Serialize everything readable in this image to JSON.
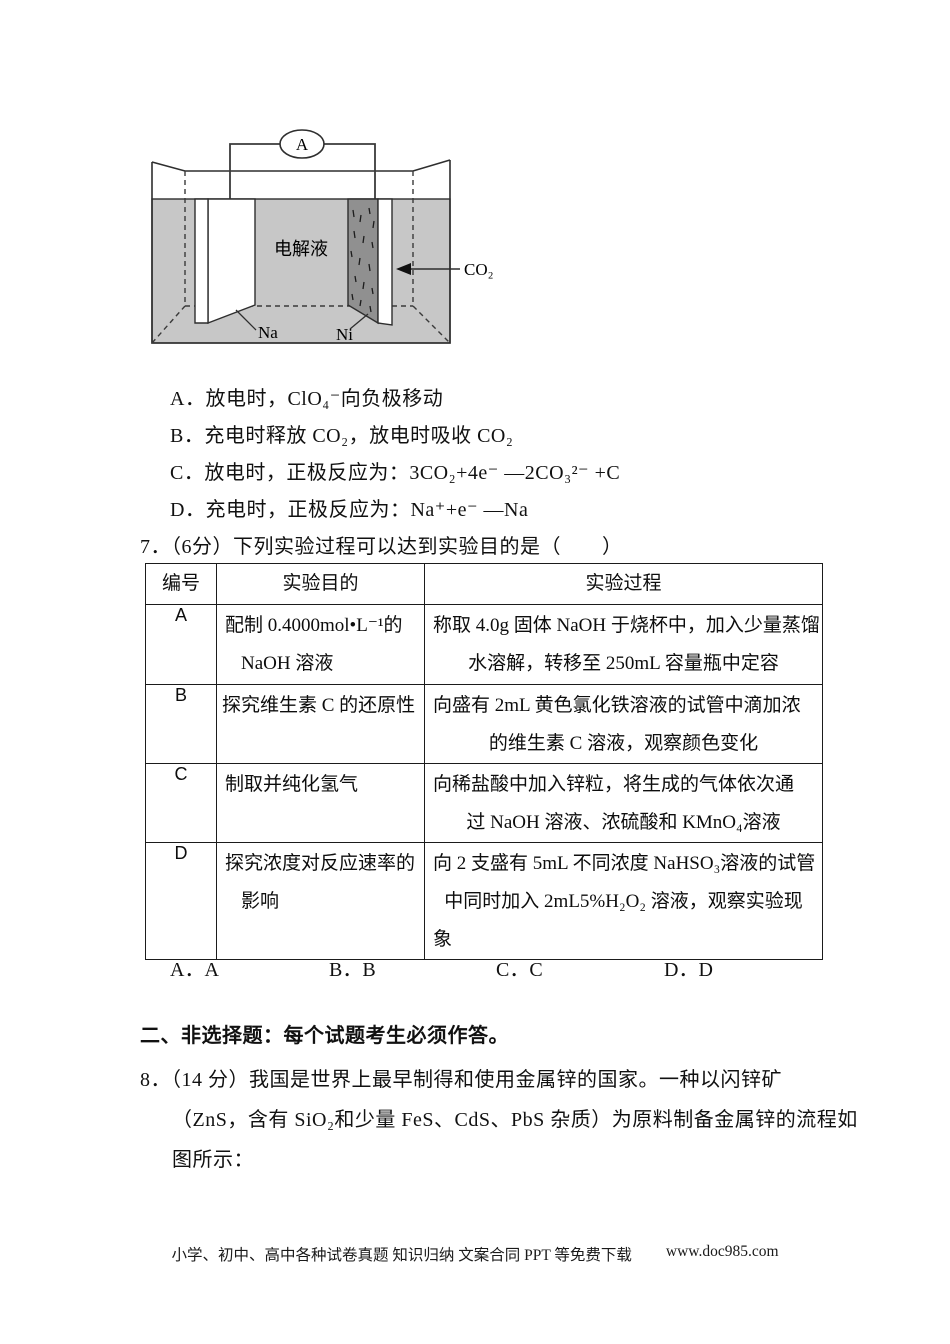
{
  "diagram": {
    "ammeter_label": "A",
    "electrolyte_label": "电解液",
    "co2_label": "CO₂",
    "left_electrode_label": "Na",
    "right_electrode_label": "Ni",
    "colors": {
      "electrolyte": "#c7c7c7",
      "cathode_fill": "#909090",
      "line": "#2e2e2e"
    }
  },
  "question6_options": [
    "A．放电时，ClO₄⁻向负极移动",
    "B．充电时释放 CO₂，放电时吸收 CO₂",
    "C．放电时，正极反应为：3CO₂+4e⁻ —2CO₃²⁻ +C",
    "D．充电时，正极反应为：Na⁺+e⁻ —Na"
  ],
  "question7": {
    "stem": "7．（6分）下列实验过程可以达到实验目的是（　　）",
    "table": {
      "headers": [
        "编号",
        "实验目的",
        "实验过程"
      ],
      "rows": [
        {
          "id": "A",
          "purpose": [
            "配制 0.4000mol•L⁻¹的",
            "NaOH 溶液"
          ],
          "process": [
            "称取 4.0g 固体 NaOH 于烧杯中，加入少量蒸馏",
            "水溶解，转移至 250mL 容量瓶中定容"
          ]
        },
        {
          "id": "B",
          "purpose": [
            "探究维生素 C 的还原性"
          ],
          "process": [
            "向盛有 2mL 黄色氯化铁溶液的试管中滴加浓",
            "的维生素 C 溶液，观察颜色变化"
          ]
        },
        {
          "id": "C",
          "purpose": [
            "制取并纯化氢气"
          ],
          "process": [
            "向稀盐酸中加入锌粒，将生成的气体依次通",
            "过 NaOH 溶液、浓硫酸和 KMnO₄溶液"
          ]
        },
        {
          "id": "D",
          "purpose": [
            "探究浓度对反应速率的",
            "影响"
          ],
          "process": [
            "向 2 支盛有 5mL 不同浓度  NaHSO₃溶液的试管",
            "中同时加入 2mL5%H₂O₂ 溶液，观察实验现",
            "象"
          ]
        }
      ]
    },
    "answer_options": [
      "A．A",
      "B．B",
      "C．C",
      "D．D"
    ]
  },
  "section2_heading": "二、非选择题：每个试题考生必须作答。",
  "question8_lines": [
    "8．（14 分）我国是世界上最早制得和使用金属锌的国家。一种以闪锌矿",
    "（ZnS，含有 SiO₂和少量 FeS、CdS、PbS 杂质）为原料制备金属锌的流程如",
    "图所示："
  ],
  "footer": {
    "promo": "小学、初中、高中各种试卷真题 知识归纳 文案合同 PPT 等免费下载",
    "site": "www.doc985.com"
  }
}
